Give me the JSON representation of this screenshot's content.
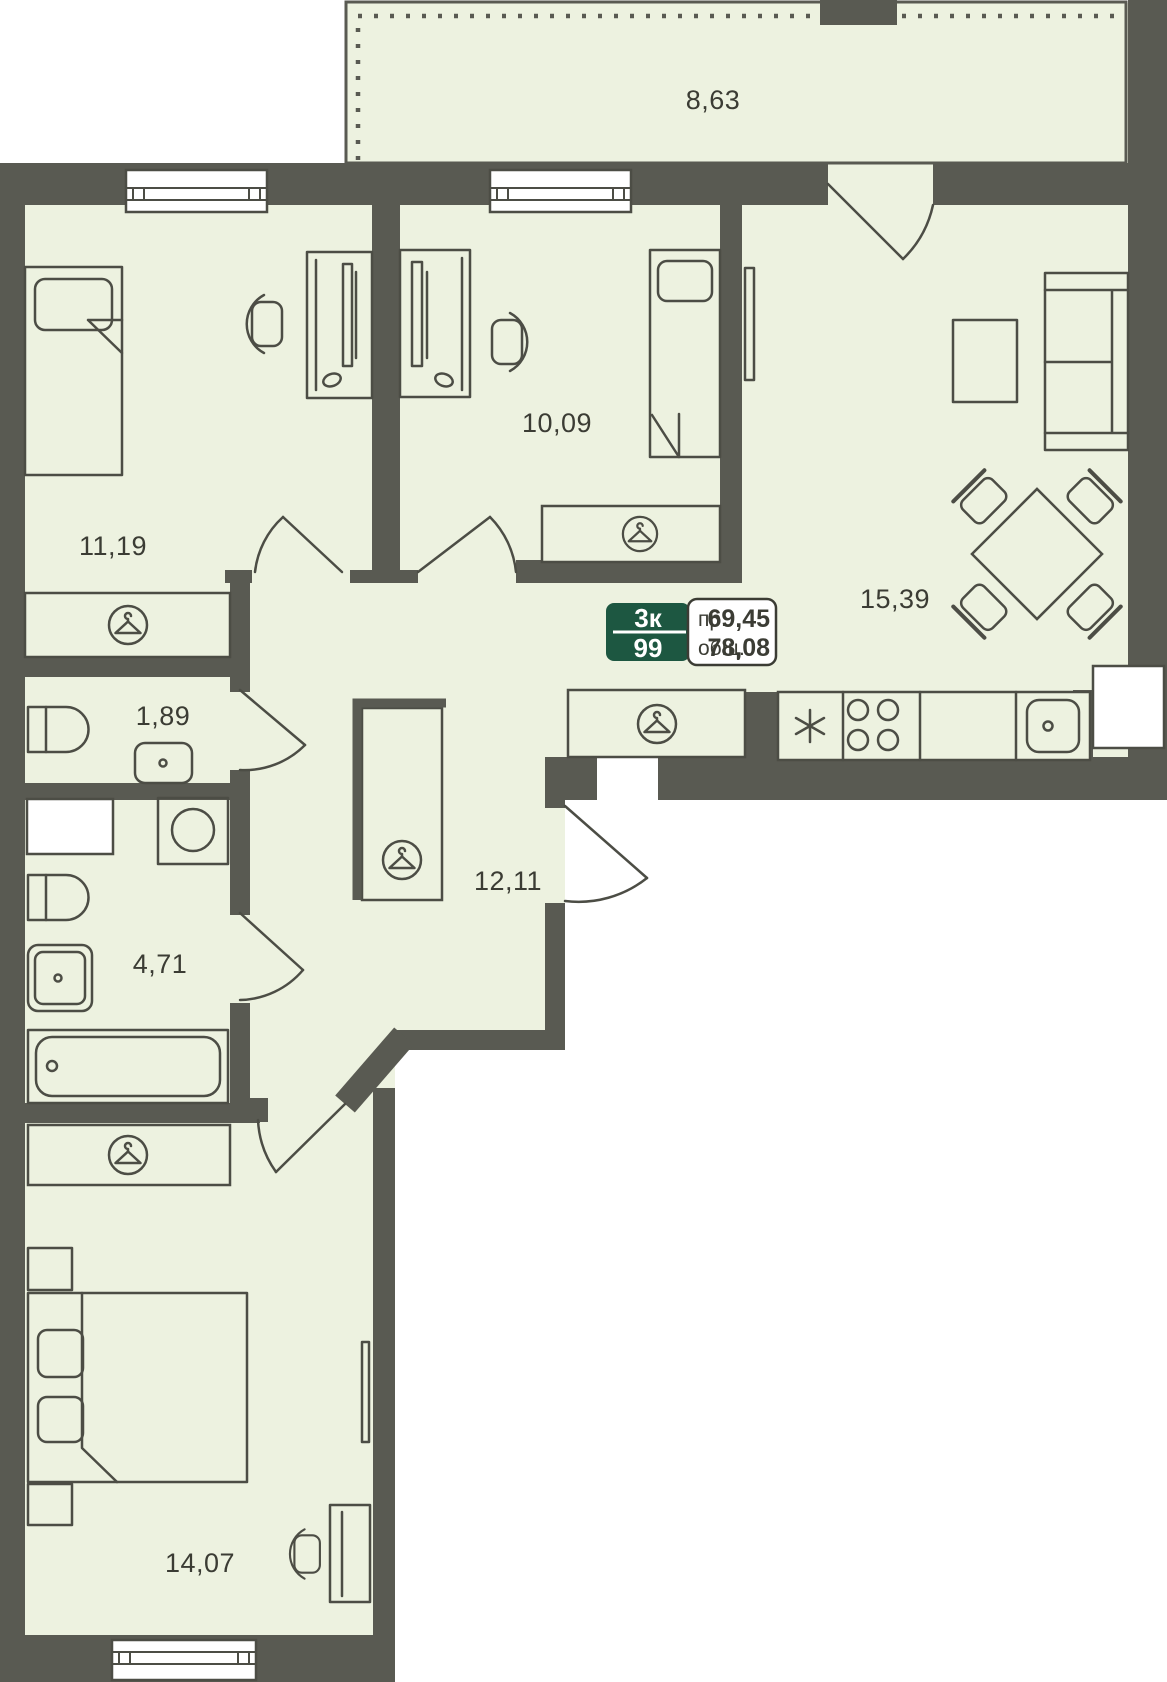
{
  "badge": {
    "rooms_short": "3к",
    "unit_number": "99",
    "projected_label": "пр.",
    "projected_value": "69,45",
    "total_label": "общ.",
    "total_value": "78,08"
  },
  "rooms": {
    "terrace": {
      "area": "8,63"
    },
    "bedroom_1": {
      "area": "11,19"
    },
    "bedroom_2": {
      "area": "10,09"
    },
    "living_kitchen": {
      "area": "15,39"
    },
    "wc": {
      "area": "1,89"
    },
    "bathroom": {
      "area": "4,71"
    },
    "hallway": {
      "area": "12,11"
    },
    "bedroom_3": {
      "area": "14,07"
    }
  },
  "icons": {
    "wardrobe_marker": "clothes-hanger-icon",
    "refrigerator_marker": "asterisk-icon",
    "stove_marker": "four-burners-icon"
  },
  "colors": {
    "wall": "#595a52",
    "floor": "#edf2e0",
    "line": "#4c4d45",
    "text": "#3b3c34",
    "accent": "#1d5741"
  }
}
